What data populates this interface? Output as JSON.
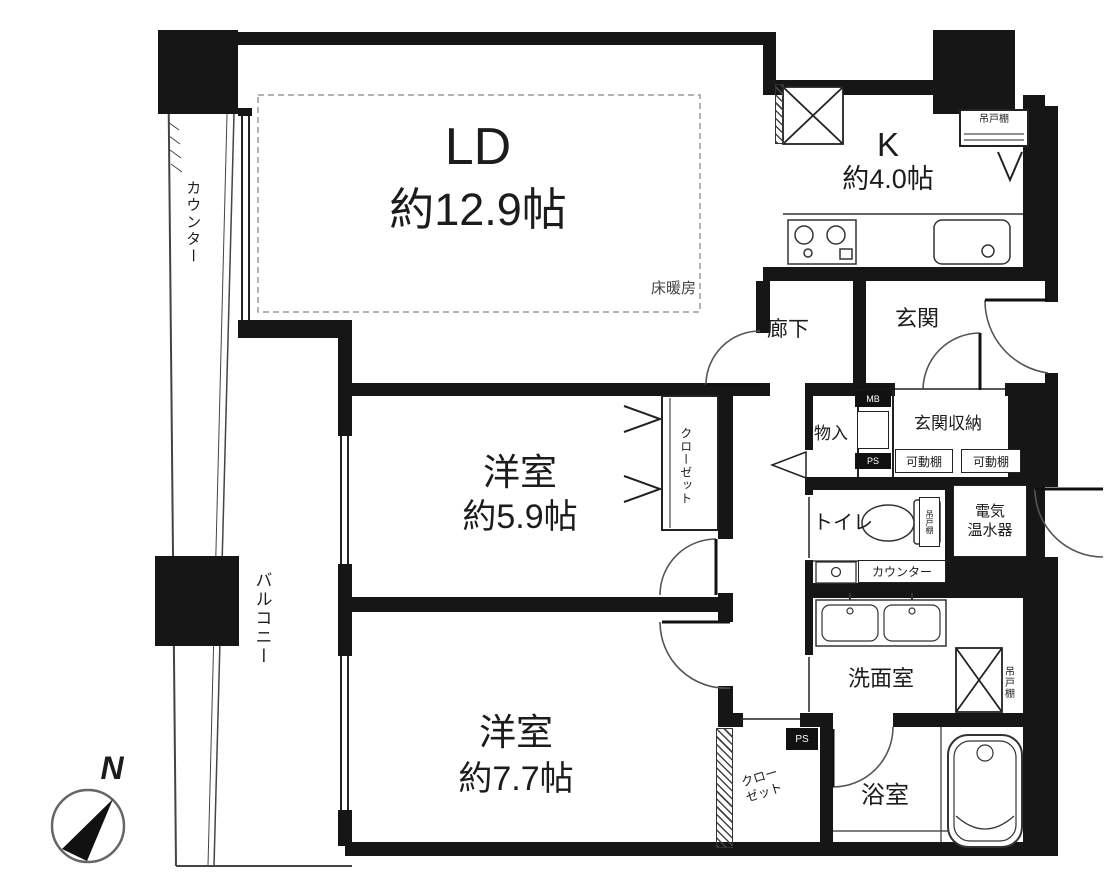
{
  "floorplan": {
    "living_dining": {
      "name": "LD",
      "size": "約12.9帖",
      "floor_heating": "床暖房"
    },
    "kitchen": {
      "name": "K",
      "size": "約4.0帖",
      "hanging_shelf": "吊戸棚"
    },
    "bedroom_1": {
      "name": "洋室",
      "size": "約5.9帖",
      "closet": "クローゼット"
    },
    "bedroom_2": {
      "name": "洋室",
      "size": "約7.7帖"
    },
    "hallway": {
      "name": "廊下"
    },
    "entrance": {
      "name": "玄関",
      "storage": "玄関収納",
      "movable_shelf_1": "可動棚",
      "movable_shelf_2": "可動棚",
      "meter_box": "MB",
      "pipe_space": "PS",
      "closet": "物入"
    },
    "toilet": {
      "name": "トイレ",
      "counter": "カウンター",
      "hanging_shelf": "吊戸棚"
    },
    "water_heater": {
      "line1": "電気",
      "line2": "温水器"
    },
    "washroom": {
      "name": "洗面室",
      "hanging_shelf": "吊戸棚"
    },
    "bathroom": {
      "name": "浴室"
    },
    "corridor_closet": {
      "name": "クローゼット",
      "pipe_space": "PS"
    },
    "balcony": {
      "name": "バルコニー",
      "counter": "カウンター"
    },
    "compass": {
      "north": "N"
    }
  }
}
